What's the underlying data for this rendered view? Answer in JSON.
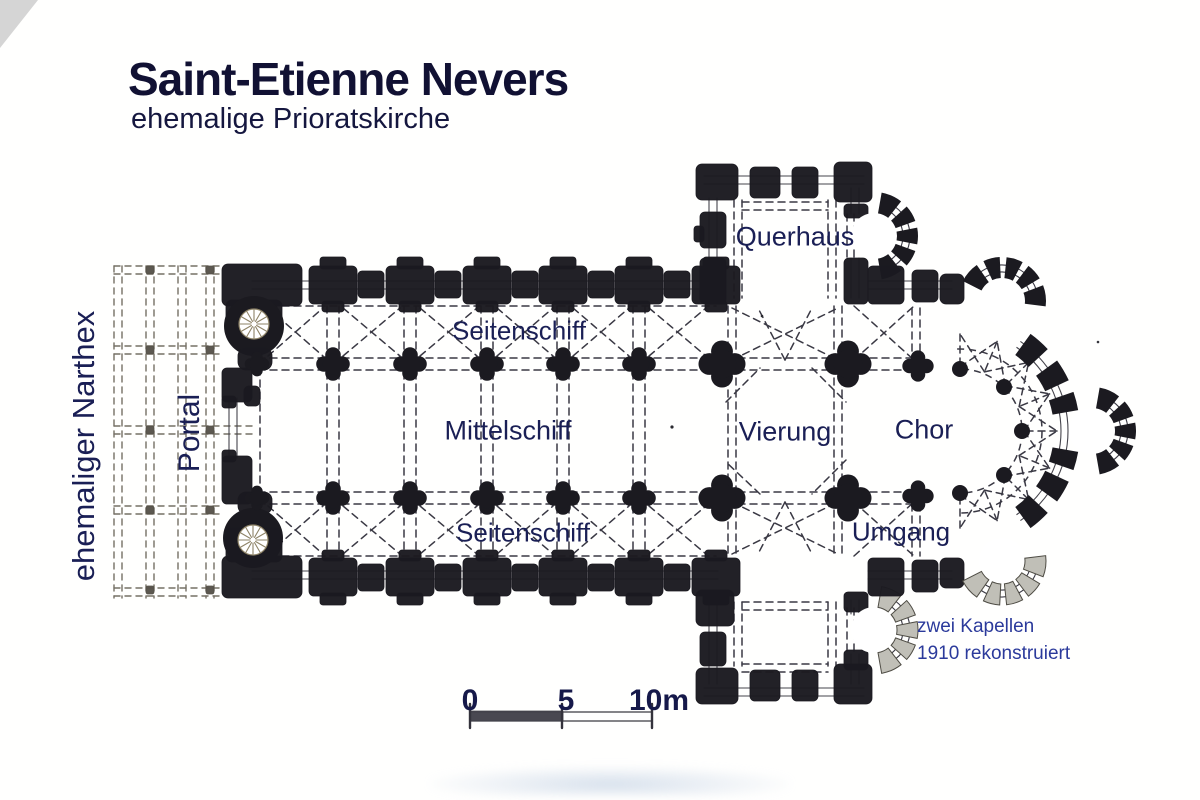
{
  "title": {
    "main": "Saint-Etienne Nevers",
    "subtitle": "ehemalige Prioratskirche"
  },
  "plan_labels": {
    "narthex": "ehemaliger Narthex",
    "portal": "Portal",
    "querhaus": "Querhaus",
    "seitenschiff_north": "Seitenschiff",
    "mittelschiff": "Mittelschiff",
    "vierung": "Vierung",
    "chor": "Chor",
    "umgang": "Umgang",
    "seitenschiff_south": "Seitenschiff",
    "kapellen_note_line1": "zwei Kapellen",
    "kapellen_note_line2": "1910 rekonstruiert"
  },
  "scale_bar": {
    "ticks": [
      "0",
      "5",
      "10m"
    ]
  },
  "colors": {
    "ink": "#1b1a20",
    "dash": "#3a3944",
    "narthex_dash": "#757065",
    "label_text": "#1a1f55",
    "title_text": "#111133",
    "note_text": "#2b3a9b",
    "scale_text": "#16194a",
    "reconstructed_fill": "#c0bfb7",
    "reconstructed_stroke": "#4e4c44",
    "stair_spoke": "#8e8367",
    "scale_bar_dark": "#43424b"
  }
}
